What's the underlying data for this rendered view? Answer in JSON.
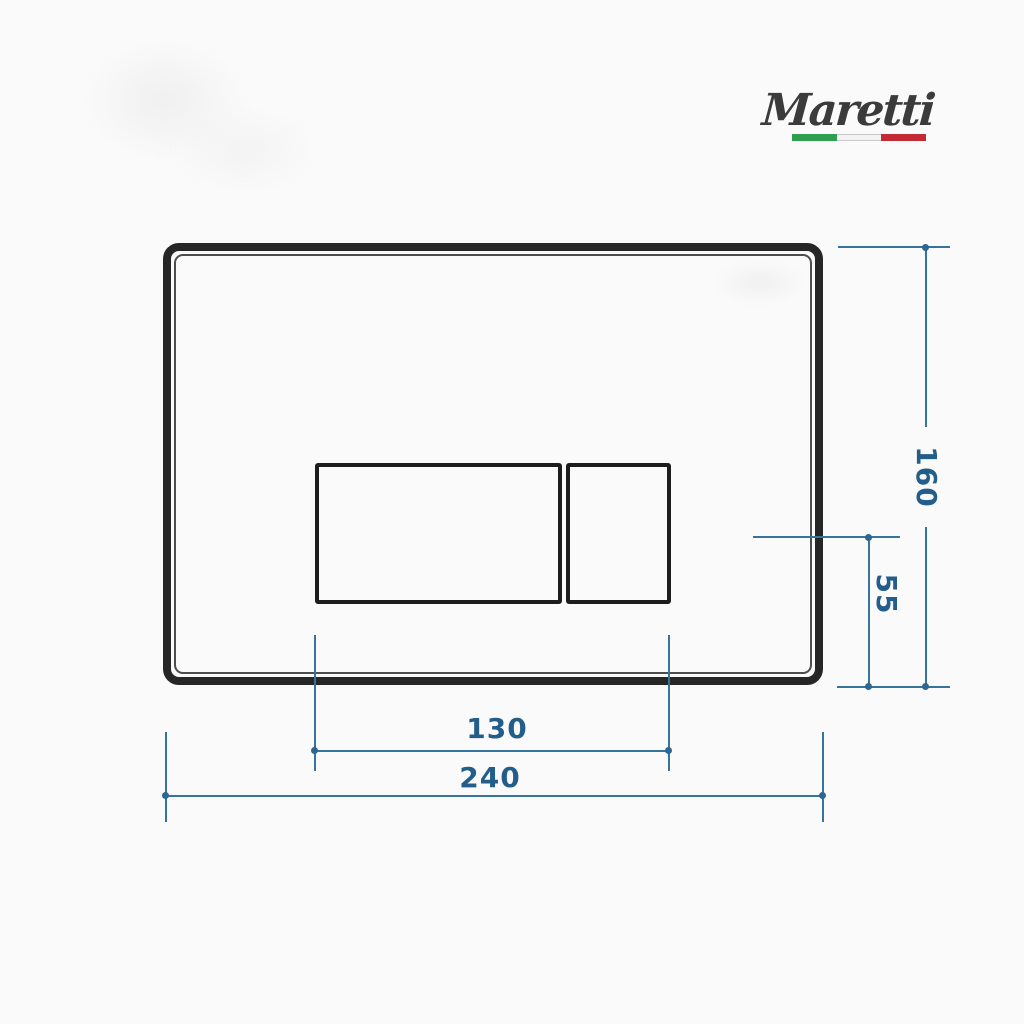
{
  "logo": {
    "brand": "Maretti",
    "flag_colors": {
      "green": "#2f9e50",
      "white": "#f3f3f3",
      "red": "#c22b35"
    }
  },
  "colors": {
    "background": "#fafafa",
    "plate_outline": "#262626",
    "button_outline": "#1d1d1d",
    "dimension_line": "#36749e",
    "dimension_text": "#235e8a"
  },
  "dimensions": {
    "plate_height": "160",
    "button_center_to_bottom": "55",
    "buttons_width": "130",
    "plate_width": "240"
  }
}
